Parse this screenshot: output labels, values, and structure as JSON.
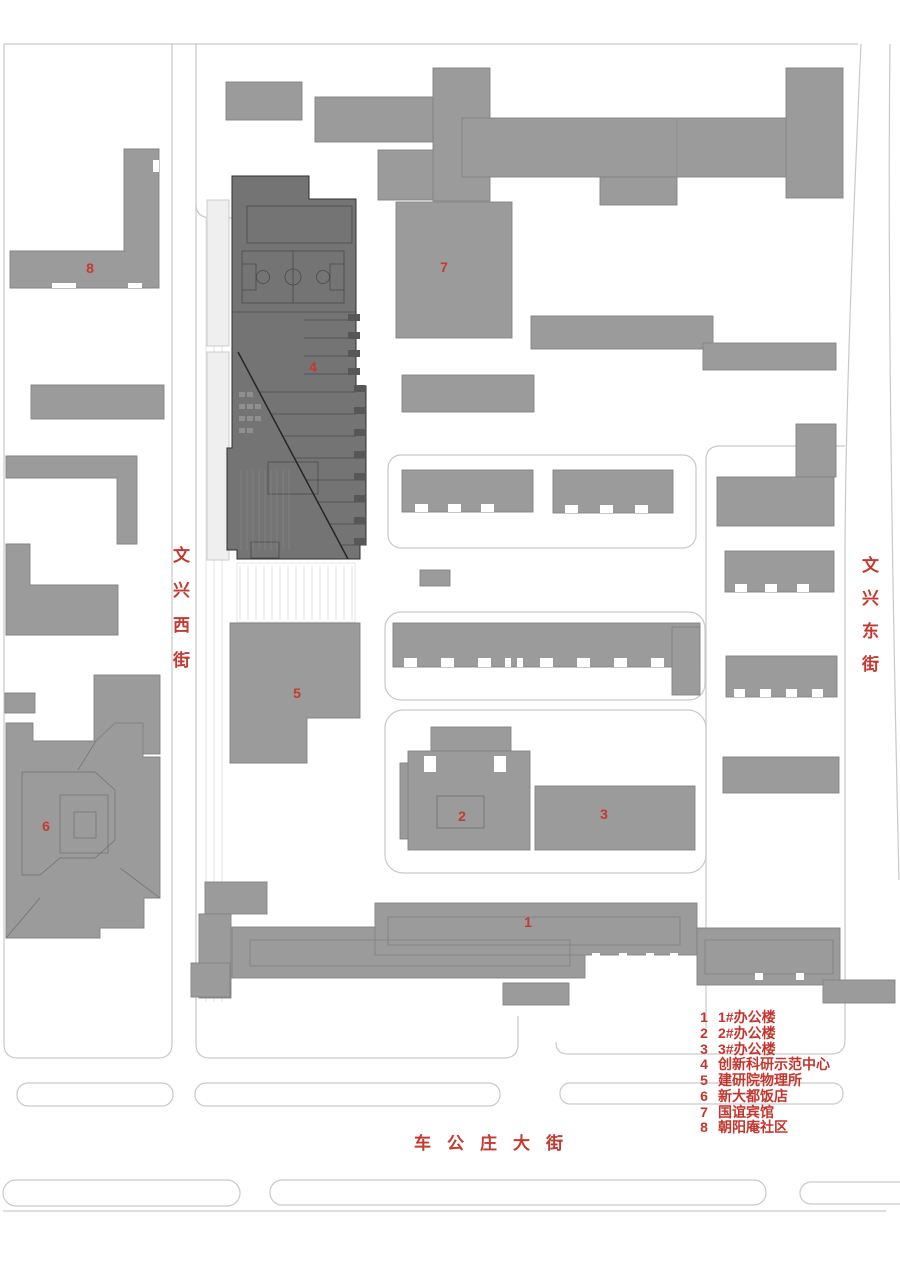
{
  "palette": {
    "background": "#ffffff",
    "building_gray": "#9b9b9b",
    "building_outline": "#838383",
    "dark_building_gray": "#747474",
    "dark_building_outline": "#2f2f2f",
    "road_line": "#c9c9c9",
    "label_red": "#c43a30"
  },
  "streets": {
    "west": {
      "name": "文兴西街"
    },
    "east": {
      "name": "文兴东街"
    },
    "south": {
      "name": "车公庄大街"
    }
  },
  "building_labels": [
    {
      "num": "1"
    },
    {
      "num": "2"
    },
    {
      "num": "3"
    },
    {
      "num": "4"
    },
    {
      "num": "5"
    },
    {
      "num": "6"
    },
    {
      "num": "7"
    },
    {
      "num": "8"
    }
  ],
  "legend": {
    "items": [
      {
        "num": "1",
        "label": "1#办公楼"
      },
      {
        "num": "2",
        "label": "2#办公楼"
      },
      {
        "num": "3",
        "label": "3#办公楼"
      },
      {
        "num": "4",
        "label": "创新科研示范中心"
      },
      {
        "num": "5",
        "label": "建研院物理所"
      },
      {
        "num": "6",
        "label": "新大都饭店"
      },
      {
        "num": "7",
        "label": "国谊宾馆"
      },
      {
        "num": "8",
        "label": "朝阳庵社区"
      }
    ]
  }
}
